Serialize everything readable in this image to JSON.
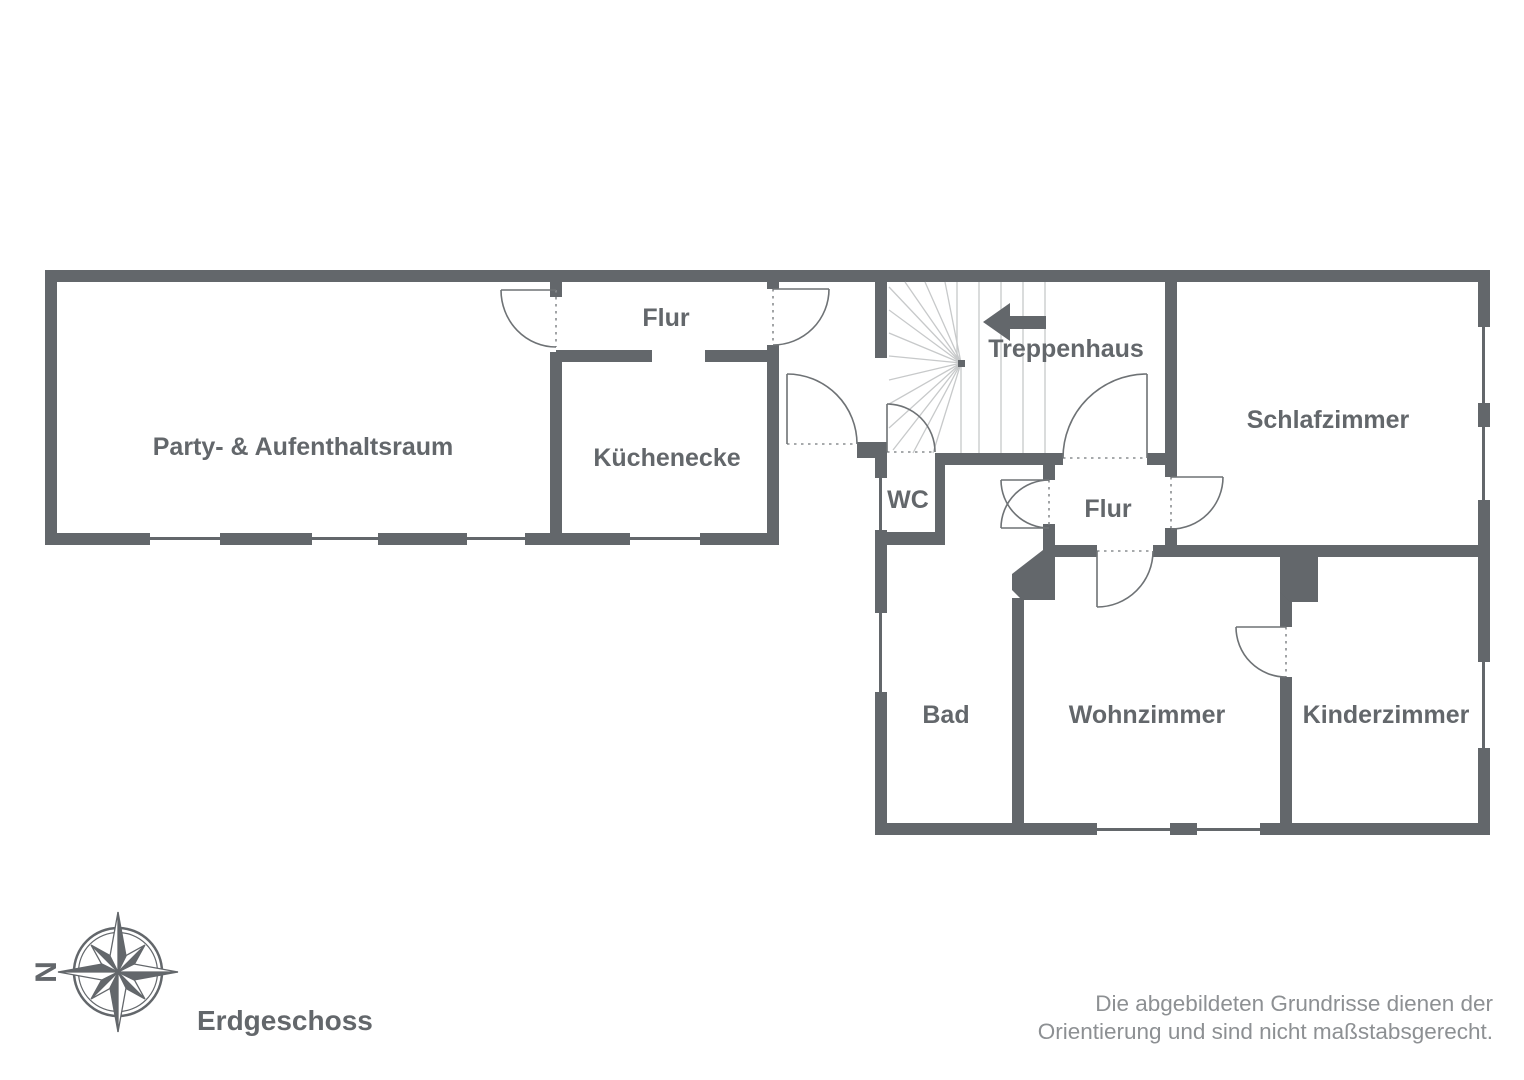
{
  "floor_plan": {
    "title": "Erdgeschoss",
    "compass": {
      "north_label": "N"
    },
    "disclaimer": {
      "line1": "Die abgebildeten Grundrisse dienen der",
      "line2": "Orientierung und sind nicht maßstabsgerecht."
    },
    "rooms": {
      "party": "Party- & Aufenthaltsraum",
      "flur_top": "Flur",
      "kueche": "Küchenecke",
      "wc": "WC",
      "treppenhaus": "Treppenhaus",
      "schlafzimmer": "Schlafzimmer",
      "flur_mitte": "Flur",
      "bad": "Bad",
      "wohnzimmer": "Wohnzimmer",
      "kinderzimmer": "Kinderzimmer"
    },
    "colors": {
      "wall": "#63676b",
      "stair_line": "#c7c9ca",
      "door_line": "#6e7275",
      "dash_line": "#8a8d90",
      "text": "#63676b",
      "disclaimer_text": "#8d9093"
    }
  }
}
